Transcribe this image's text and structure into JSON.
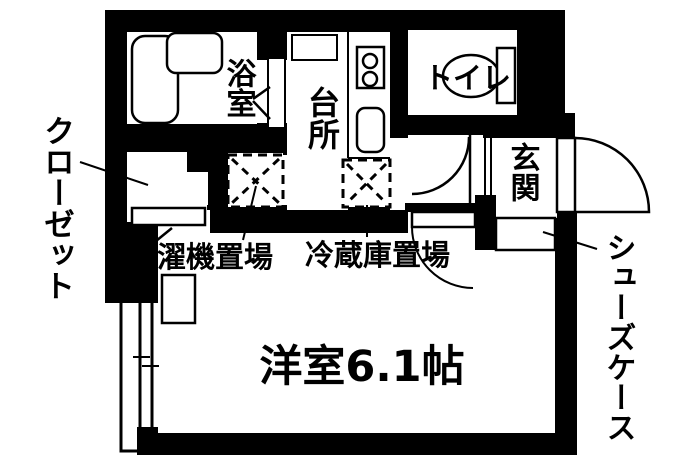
{
  "plan": {
    "type": "floorplan",
    "colors": {
      "wall": "#000000",
      "floor": "#ffffff",
      "line": "#000000"
    },
    "labels": {
      "bathroom": "浴室",
      "kitchen": "台所",
      "toilet": "トイレ",
      "entrance": "玄関",
      "closet": "クローゼット",
      "washing_machine_space": "洗濯機置場",
      "refrigerator_space": "冷蔵庫置場",
      "main_room": "洋室6.1帖",
      "shoe_case": "シューズケース"
    },
    "fixtures": [
      "bathtub",
      "vanity-sink",
      "stove-two-burner",
      "kitchen-sink",
      "toilet-bowl",
      "toilet-tank",
      "washing-machine-pan",
      "refrigerator-pan",
      "sliding-window",
      "entry-door-swing",
      "hall-door-swing",
      "room-door-swing",
      "shoe-cabinet",
      "closet-folding-door"
    ]
  }
}
